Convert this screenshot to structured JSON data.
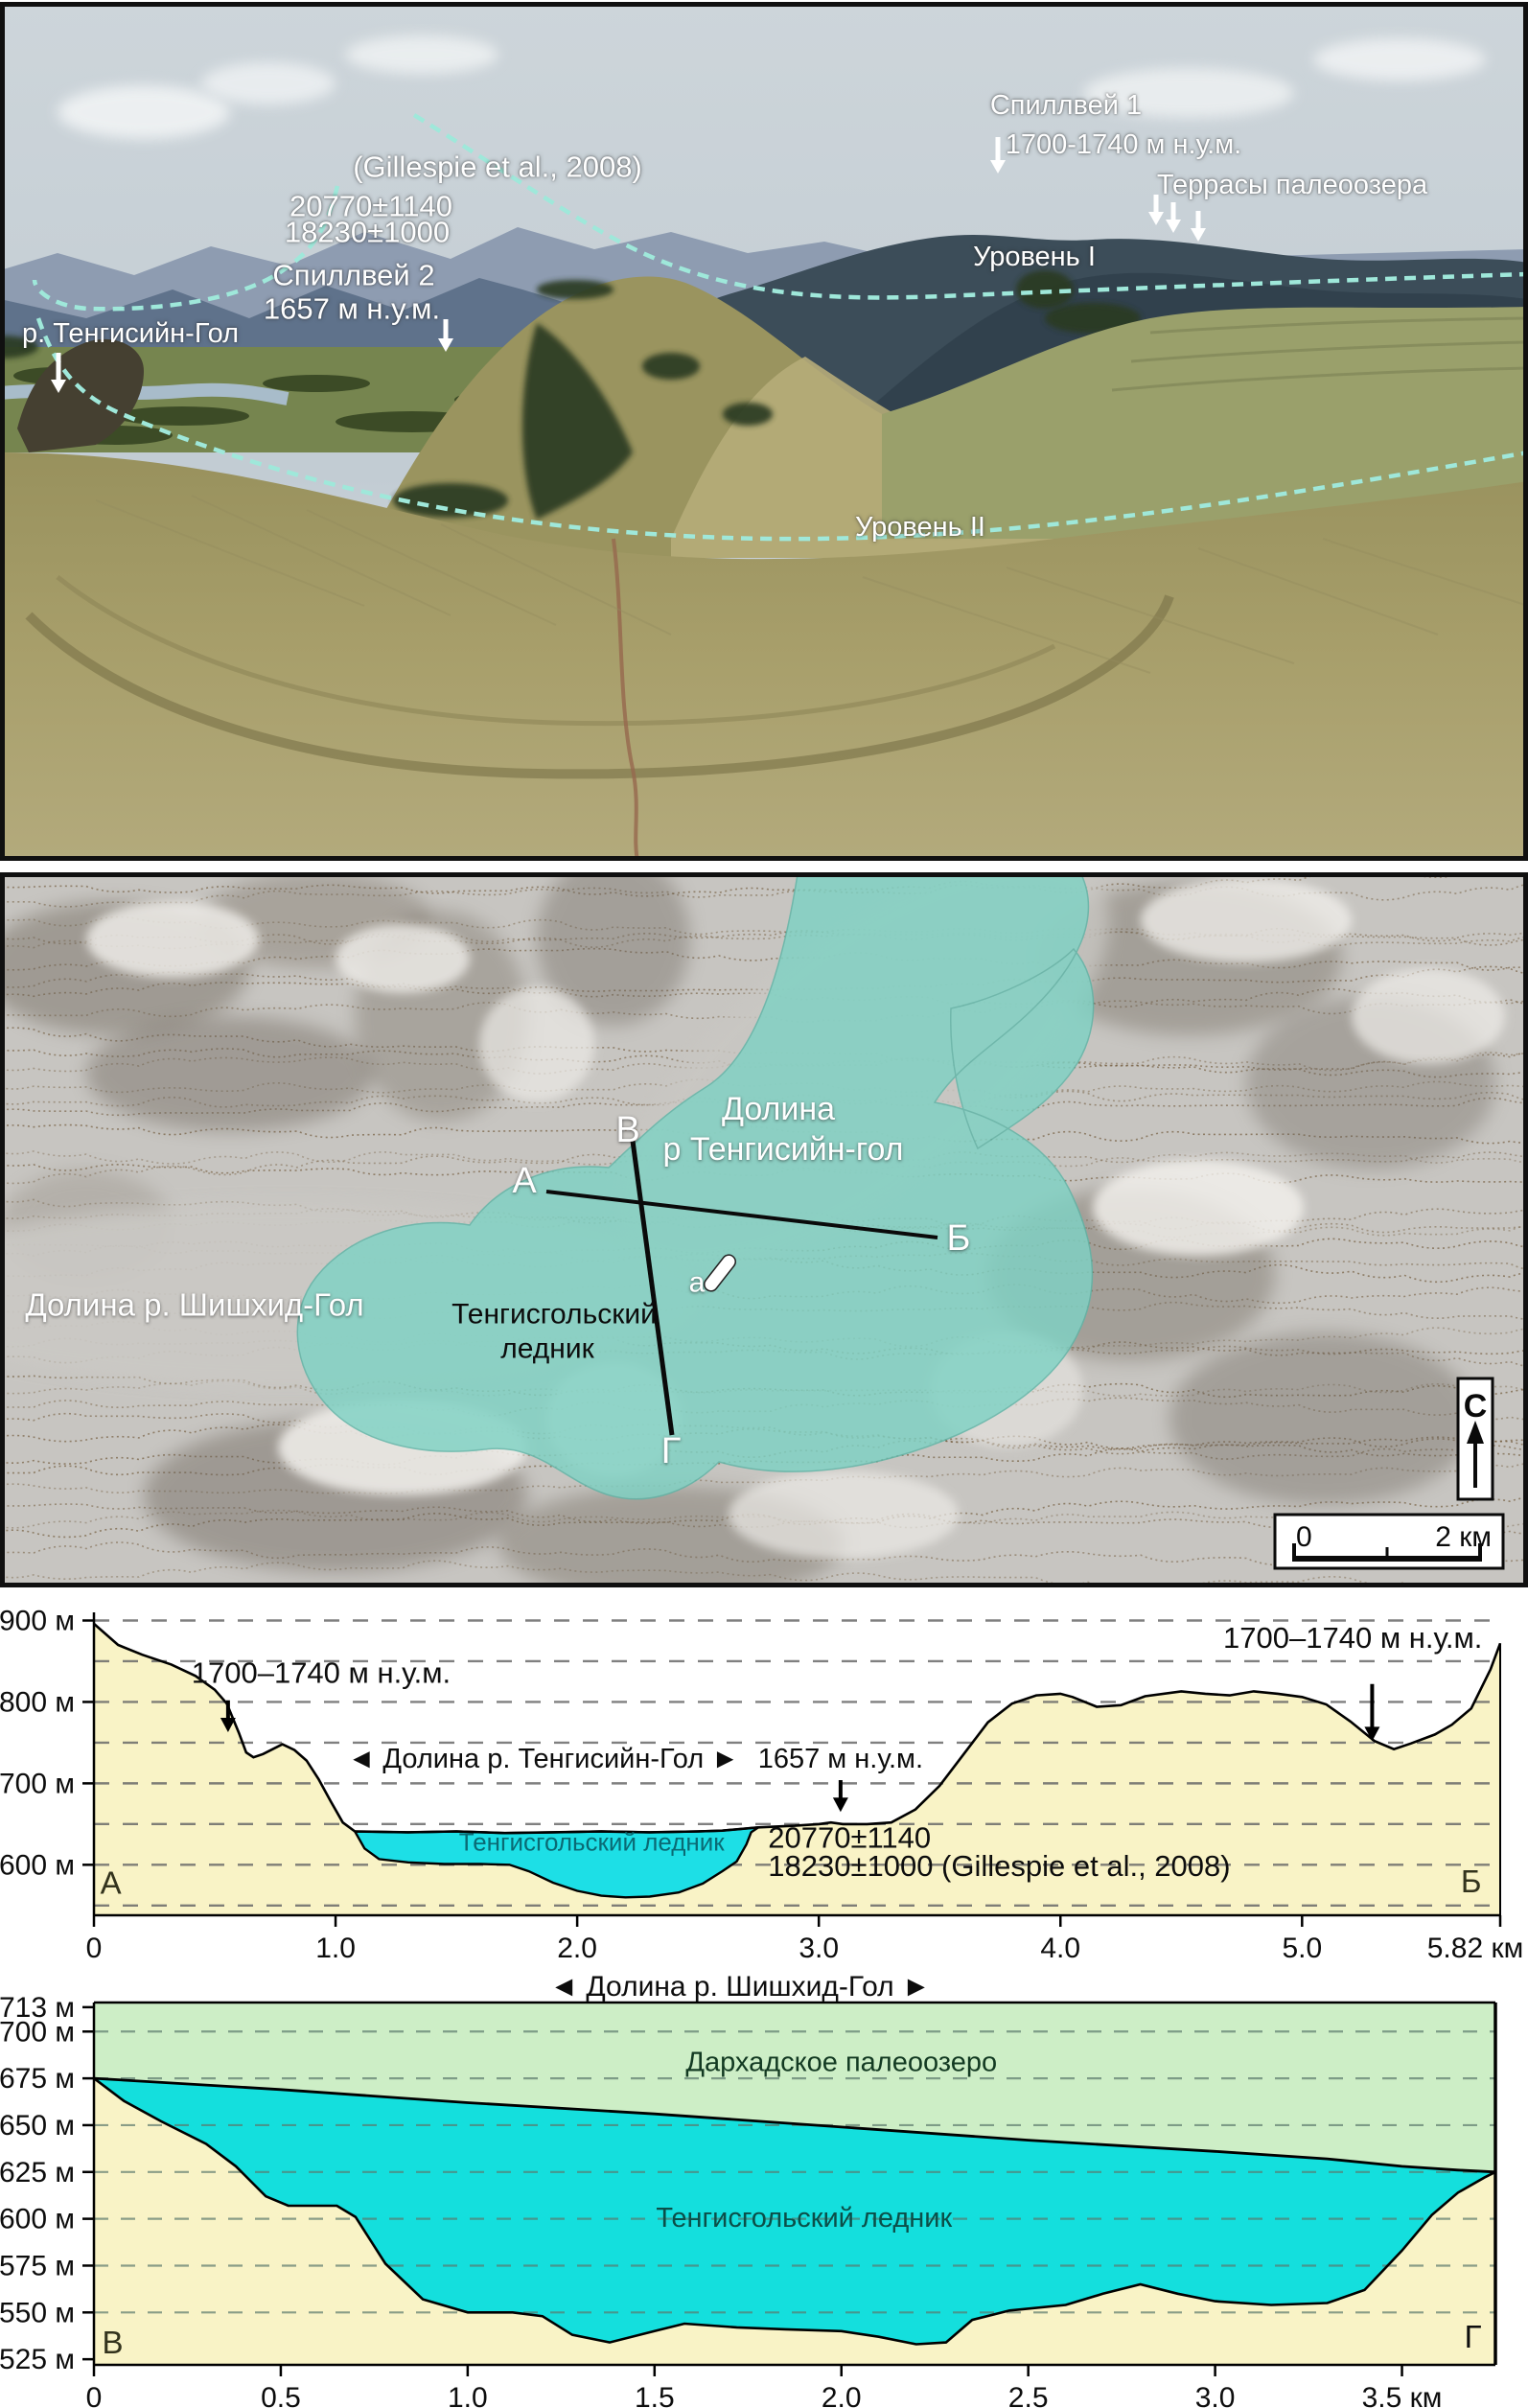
{
  "photo": {
    "labels": [
      {
        "id": "gillespie-ref",
        "text": "(Gillespie et al., 2008)",
        "x": 519,
        "y": 175,
        "fs": 31
      },
      {
        "id": "age-note-1",
        "text": "20770±1140",
        "x": 387,
        "y": 216,
        "fs": 31
      },
      {
        "id": "age-note-2",
        "text": "18230±1000",
        "x": 383,
        "y": 243,
        "fs": 31
      },
      {
        "id": "spillway-2",
        "text": "Спиллвей 2",
        "x": 369,
        "y": 288,
        "fs": 31
      },
      {
        "id": "spillway-2-elev",
        "text": "1657 м н.у.м.",
        "x": 367,
        "y": 323,
        "fs": 31
      },
      {
        "id": "river-tengisiin",
        "text": "р. Тенгисийн-Гол",
        "x": 136,
        "y": 348,
        "fs": 29
      },
      {
        "id": "spillway-1",
        "text": "Спиллвей 1",
        "x": 1112,
        "y": 110,
        "fs": 29
      },
      {
        "id": "spillway-1-elev",
        "text": "1700-1740 м н.у.м.",
        "x": 1172,
        "y": 151,
        "fs": 29
      },
      {
        "id": "paleolake-terraces",
        "text": "Террасы палеоозера",
        "x": 1348,
        "y": 193,
        "fs": 29
      },
      {
        "id": "level-1",
        "text": "Уровень I",
        "x": 1079,
        "y": 268,
        "fs": 29
      },
      {
        "id": "level-2",
        "text": "Уровень II",
        "x": 960,
        "y": 550,
        "fs": 29
      }
    ],
    "arrows": [
      {
        "id": "spillway-2-arrow",
        "x": 465,
        "y1": 333,
        "y2": 363
      },
      {
        "id": "river-arrow",
        "x": 61,
        "y1": 368,
        "y2": 406
      },
      {
        "id": "spillway-1-arrow",
        "x": 1041,
        "y1": 143,
        "y2": 177
      },
      {
        "id": "terrace-arrow-1",
        "x": 1206,
        "y1": 203,
        "y2": 231
      },
      {
        "id": "terrace-arrow-2",
        "x": 1224,
        "y1": 211,
        "y2": 239
      },
      {
        "id": "terrace-arrow-3",
        "x": 1250,
        "y1": 220,
        "y2": 248
      }
    ]
  },
  "map": {
    "labels": [
      {
        "id": "map-valley-tengisiin-line1",
        "text": "Долина",
        "x": 812,
        "y": 1158,
        "cls": "white",
        "fs": 34
      },
      {
        "id": "map-valley-tengisiin-line2",
        "text": "р Тенгисийн-гол",
        "x": 817,
        "y": 1200,
        "cls": "white",
        "fs": 34
      },
      {
        "id": "map-valley-shishkhid",
        "text": "Долина р. Шишхид-Гол",
        "x": 203,
        "y": 1362,
        "cls": "white",
        "fs": 33
      },
      {
        "id": "map-glacier-line1",
        "text": "Тенгисгольский",
        "x": 578,
        "y": 1371,
        "cls": "black",
        "fs": 30
      },
      {
        "id": "map-glacier-line2",
        "text": "ледник",
        "x": 571,
        "y": 1407,
        "cls": "black",
        "fs": 30
      },
      {
        "id": "map-point-A",
        "text": "А",
        "x": 547,
        "y": 1233,
        "cls": "white",
        "fs": 38
      },
      {
        "id": "map-point-B",
        "text": "Б",
        "x": 1000,
        "y": 1293,
        "cls": "white",
        "fs": 38
      },
      {
        "id": "map-point-V",
        "text": "В",
        "x": 655,
        "y": 1180,
        "cls": "white",
        "fs": 38
      },
      {
        "id": "map-point-G",
        "text": "Г",
        "x": 700,
        "y": 1515,
        "cls": "white",
        "fs": 38
      },
      {
        "id": "map-site-a",
        "text": "а",
        "x": 727,
        "y": 1338,
        "cls": "white",
        "fs": 30
      }
    ],
    "north_label": "С",
    "scale": {
      "start": "0",
      "end": "2 км"
    },
    "glacier_color": "#7fd2c4"
  },
  "chart_data": [
    {
      "type": "area",
      "id": "profile-A-B",
      "x_unit": "км",
      "y_unit": "м",
      "xlim": [
        0,
        5.82
      ],
      "ylim": [
        1538,
        1910
      ],
      "grid": true,
      "grid_values": [
        1550,
        1600,
        1650,
        1700,
        1750,
        1800,
        1850,
        1900
      ],
      "yticks": [
        {
          "v": 1600,
          "label": "1600 м"
        },
        {
          "v": 1700,
          "label": "1700 м"
        },
        {
          "v": 1800,
          "label": "1800 м"
        },
        {
          "v": 1900,
          "label": "1900 м"
        }
      ],
      "xticks": [
        {
          "v": 0,
          "label": "0"
        },
        {
          "v": 1,
          "label": "1.0"
        },
        {
          "v": 2,
          "label": "2.0"
        },
        {
          "v": 3,
          "label": "3.0"
        },
        {
          "v": 4,
          "label": "4.0"
        },
        {
          "v": 5,
          "label": "5.0"
        },
        {
          "v": 5.82,
          "label": "5.82 км",
          "dx": -26
        }
      ],
      "terrain": [
        [
          0,
          1896
        ],
        [
          0.1,
          1870
        ],
        [
          0.2,
          1858
        ],
        [
          0.32,
          1846
        ],
        [
          0.42,
          1832
        ],
        [
          0.5,
          1815
        ],
        [
          0.55,
          1798
        ],
        [
          0.6,
          1762
        ],
        [
          0.63,
          1738
        ],
        [
          0.66,
          1732
        ],
        [
          0.7,
          1736
        ],
        [
          0.74,
          1742
        ],
        [
          0.78,
          1748
        ],
        [
          0.83,
          1741
        ],
        [
          0.88,
          1728
        ],
        [
          0.93,
          1705
        ],
        [
          0.98,
          1678
        ],
        [
          1.03,
          1652
        ],
        [
          1.08,
          1641
        ],
        [
          1.3,
          1640
        ],
        [
          1.5,
          1641
        ],
        [
          1.7,
          1639
        ],
        [
          1.9,
          1640
        ],
        [
          2.1,
          1641
        ],
        [
          2.3,
          1640
        ],
        [
          2.5,
          1641
        ],
        [
          2.6,
          1642
        ],
        [
          2.75,
          1646
        ],
        [
          2.9,
          1648
        ],
        [
          3.0,
          1650
        ],
        [
          3.05,
          1652
        ],
        [
          3.1,
          1650
        ],
        [
          3.2,
          1650
        ],
        [
          3.3,
          1652
        ],
        [
          3.4,
          1668
        ],
        [
          3.5,
          1697
        ],
        [
          3.6,
          1736
        ],
        [
          3.7,
          1775
        ],
        [
          3.8,
          1798
        ],
        [
          3.9,
          1808
        ],
        [
          4.0,
          1810
        ],
        [
          4.05,
          1806
        ],
        [
          4.15,
          1794
        ],
        [
          4.25,
          1796
        ],
        [
          4.35,
          1807
        ],
        [
          4.5,
          1813
        ],
        [
          4.6,
          1810
        ],
        [
          4.7,
          1808
        ],
        [
          4.8,
          1813
        ],
        [
          4.9,
          1810
        ],
        [
          5.0,
          1806
        ],
        [
          5.1,
          1797
        ],
        [
          5.2,
          1776
        ],
        [
          5.3,
          1752
        ],
        [
          5.38,
          1742
        ],
        [
          5.45,
          1749
        ],
        [
          5.55,
          1760
        ],
        [
          5.62,
          1772
        ],
        [
          5.7,
          1792
        ],
        [
          5.78,
          1840
        ],
        [
          5.82,
          1872
        ]
      ],
      "glacier_bed": [
        [
          1.08,
          1641
        ],
        [
          1.12,
          1620
        ],
        [
          1.18,
          1607
        ],
        [
          1.3,
          1603
        ],
        [
          1.45,
          1601
        ],
        [
          1.6,
          1601
        ],
        [
          1.72,
          1600
        ],
        [
          1.8,
          1592
        ],
        [
          1.9,
          1578
        ],
        [
          2.0,
          1568
        ],
        [
          2.1,
          1562
        ],
        [
          2.2,
          1560
        ],
        [
          2.3,
          1561
        ],
        [
          2.42,
          1566
        ],
        [
          2.52,
          1577
        ],
        [
          2.6,
          1592
        ],
        [
          2.66,
          1604
        ],
        [
          2.7,
          1625
        ],
        [
          2.72,
          1640
        ],
        [
          2.75,
          1646
        ]
      ],
      "annotations": [
        {
          "id": "elev-note-left",
          "text": "1700–1740 м н.у.м.",
          "km": 0.94,
          "m": 1836,
          "fs": 31
        },
        {
          "id": "valley-note",
          "text": "◄  Долина р. Тенгисийн-Гол  ►",
          "km": 1.86,
          "m": 1731,
          "fs": 29
        },
        {
          "id": "spillway2-note",
          "text": "1657 м н.у.м.",
          "km": 3.09,
          "m": 1731,
          "fs": 29
        },
        {
          "id": "age-note-1",
          "text": "20770±1140",
          "km": 2.79,
          "m": 1634,
          "fs": 31,
          "align": "start"
        },
        {
          "id": "age-note-2",
          "text": "18230±1000  (Gillespie et al., 2008)",
          "km": 2.79,
          "m": 1599,
          "fs": 31,
          "align": "start"
        },
        {
          "id": "glacier-name",
          "text": "Тенгисгольский ледник",
          "km": 2.06,
          "m": 1628,
          "fs": 26,
          "color": "#0a6a74"
        },
        {
          "id": "elev-note-right",
          "text": "1700–1740 м н.у.м.",
          "km": 5.21,
          "m": 1879,
          "fs": 31
        },
        {
          "id": "endpoint-A",
          "text": "А",
          "km": 0.07,
          "m": 1578,
          "fs": 33,
          "color": "#33331d"
        },
        {
          "id": "endpoint-B",
          "text": "Б",
          "km": 5.7,
          "m": 1580,
          "fs": 33,
          "color": "#33331d"
        }
      ],
      "arrows": [
        {
          "km": 0.555,
          "m1": 1802,
          "m2": 1764
        },
        {
          "km": 3.09,
          "m1": 1704,
          "m2": 1666
        },
        {
          "km": 5.29,
          "m1": 1822,
          "m2": 1753
        }
      ],
      "colors": {
        "terrain_fill": "#f9f3c6",
        "glacier_fill": "#1ddfe6",
        "grid": "#6a6a6a",
        "line": "#000000"
      }
    },
    {
      "type": "area",
      "id": "profile-V-G",
      "title": "◄ Долина р. Шишхид-Гол ►",
      "x_unit": "км",
      "y_unit": "м",
      "xlim": [
        0,
        3.75
      ],
      "ylim": [
        1522,
        1715.5
      ],
      "grid": true,
      "grid_values": [
        1550,
        1575,
        1600,
        1625,
        1650,
        1675,
        1700
      ],
      "yticks": [
        {
          "v": 1713,
          "label": "1713 м"
        },
        {
          "v": 1700,
          "label": "1700 м"
        },
        {
          "v": 1675,
          "label": "1675 м"
        },
        {
          "v": 1650,
          "label": "1650 м"
        },
        {
          "v": 1625,
          "label": "1625 м"
        },
        {
          "v": 1600,
          "label": "1600 м"
        },
        {
          "v": 1575,
          "label": "1575 м"
        },
        {
          "v": 1550,
          "label": "1550 м"
        },
        {
          "v": 1525,
          "label": "1525 м"
        }
      ],
      "xticks": [
        {
          "v": 0,
          "label": "0"
        },
        {
          "v": 0.5,
          "label": "0.5"
        },
        {
          "v": 1,
          "label": "1.0"
        },
        {
          "v": 1.5,
          "label": "1.5"
        },
        {
          "v": 2,
          "label": "2.0"
        },
        {
          "v": 2.5,
          "label": "2.5"
        },
        {
          "v": 3,
          "label": "3.0"
        },
        {
          "v": 3.5,
          "label": "3.5 км"
        }
      ],
      "glacier_surface": [
        [
          0,
          1675
        ],
        [
          0.5,
          1669
        ],
        [
          1.0,
          1662
        ],
        [
          1.5,
          1656
        ],
        [
          2.0,
          1649
        ],
        [
          2.5,
          1642
        ],
        [
          3.0,
          1636
        ],
        [
          3.3,
          1632
        ],
        [
          3.5,
          1628
        ],
        [
          3.65,
          1626
        ],
        [
          3.75,
          1625
        ]
      ],
      "bed": [
        [
          0,
          1675
        ],
        [
          0.08,
          1663
        ],
        [
          0.18,
          1652
        ],
        [
          0.3,
          1640
        ],
        [
          0.38,
          1628
        ],
        [
          0.46,
          1612
        ],
        [
          0.52,
          1607
        ],
        [
          0.65,
          1607
        ],
        [
          0.7,
          1601
        ],
        [
          0.78,
          1576
        ],
        [
          0.88,
          1557
        ],
        [
          1.0,
          1550
        ],
        [
          1.12,
          1550
        ],
        [
          1.2,
          1548
        ],
        [
          1.28,
          1538
        ],
        [
          1.38,
          1534
        ],
        [
          1.5,
          1540
        ],
        [
          1.58,
          1544
        ],
        [
          1.72,
          1542
        ],
        [
          1.85,
          1541
        ],
        [
          2.0,
          1540
        ],
        [
          2.1,
          1537
        ],
        [
          2.2,
          1533
        ],
        [
          2.28,
          1534
        ],
        [
          2.35,
          1546
        ],
        [
          2.45,
          1551
        ],
        [
          2.6,
          1554
        ],
        [
          2.7,
          1560
        ],
        [
          2.8,
          1565
        ],
        [
          2.9,
          1560
        ],
        [
          3.0,
          1556
        ],
        [
          3.15,
          1554
        ],
        [
          3.3,
          1555
        ],
        [
          3.4,
          1562
        ],
        [
          3.5,
          1583
        ],
        [
          3.58,
          1602
        ],
        [
          3.65,
          1614
        ],
        [
          3.72,
          1622
        ],
        [
          3.75,
          1625
        ]
      ],
      "annotations": [
        {
          "id": "paleolake-name",
          "text": "Дархадское палеоозеро",
          "km": 2.0,
          "m": 1684,
          "fs": 29,
          "color": "#133a22"
        },
        {
          "id": "glacier-name",
          "text": "Тенгисгольский ледник",
          "km": 1.9,
          "m": 1601,
          "fs": 29,
          "color": "#0b4f49"
        },
        {
          "id": "endpoint-V",
          "text": "В",
          "km": 0.05,
          "m": 1534,
          "fs": 33,
          "color": "#33331d"
        },
        {
          "id": "endpoint-G",
          "text": "Г",
          "km": 3.69,
          "m": 1537,
          "fs": 33,
          "color": "#0d0d0d"
        }
      ],
      "arrows": [],
      "colors": {
        "lake_fill": "#cdeec6",
        "glacier_fill": "#14dfdd",
        "bed_fill": "#f9f3c6",
        "grid": "#5c7a6d",
        "line": "#000000"
      }
    }
  ]
}
